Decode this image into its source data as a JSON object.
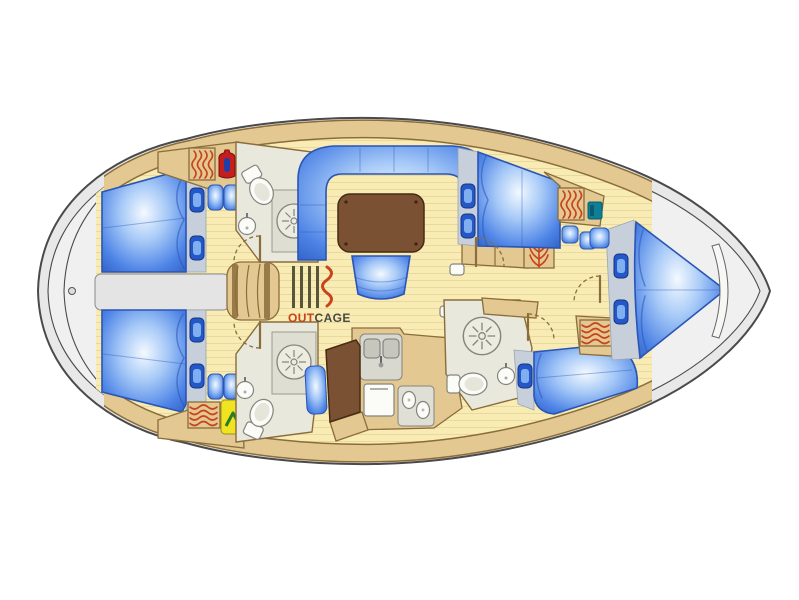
{
  "page": {
    "background": "#FFFFFF",
    "description": "Top-down interior floor plan of a sailing yacht"
  },
  "logo": {
    "out": "OUT",
    "cage": "CAGE"
  },
  "colors": {
    "hull-gray": "#E8E8E8",
    "deck-gray": "#F0F0F0",
    "outline": "#4A4A4A",
    "floor-cream": "#F8ECB4",
    "plank-line": "#E9D99C",
    "furniture-tan": "#E3C892",
    "wood-line": "#8A6D3B",
    "bed-blue": "#3D74DE",
    "bed-navy": "#2A55B4",
    "pillow-blue": "#2458C8",
    "platform-gray": "#C7CFDA",
    "head-floor": "#E9E8DC",
    "fixture-white": "#FBFBF8",
    "table-brown": "#7A5233",
    "accent-red": "#C8441C",
    "vest-yellow": "#F0E31F",
    "vest-green": "#2A7A2A",
    "hatch-teal": "#0E7F96",
    "logo-orange": "#C8441C",
    "logo-dark": "#4A4A42",
    "logo-olive": "#56563A"
  },
  "icons": [
    "heater-icon",
    "shower-icon",
    "toilet-icon",
    "sink-icon",
    "pillow-icon",
    "seat-cushion-icon",
    "red-jacket-icon",
    "life-vest-icon",
    "teal-hatch-icon",
    "branch-hooks-icon",
    "porthole-icon",
    "logo-bars-icon",
    "logo-wave-icon"
  ],
  "rooms": [
    "stern-deck",
    "aft-port-cabin",
    "aft-starboard-cabin",
    "aft-port-head",
    "aft-starboard-head",
    "companionway",
    "saloon",
    "galley",
    "nav-station",
    "forward-head",
    "forward-port-cabin",
    "forward-starboard-cabin",
    "v-berth-cabin",
    "bow-locker"
  ]
}
